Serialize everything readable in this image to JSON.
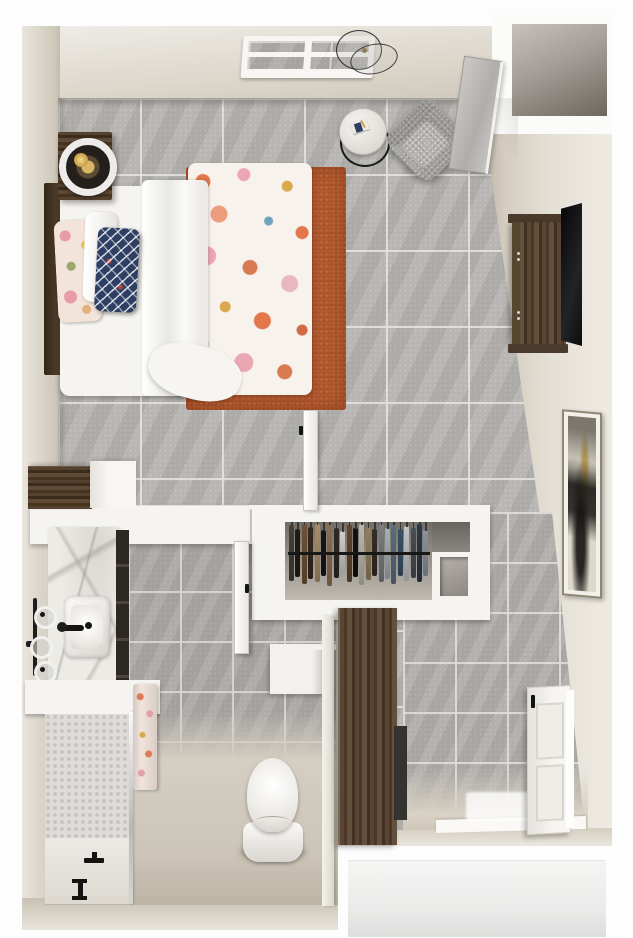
{
  "scene": {
    "type": "3d-floor-plan-render",
    "title": "Studio apartment top-down 3D floor plan rendering",
    "canvas": {
      "width": 633,
      "height": 938
    },
    "visible_text": "none"
  },
  "palette": {
    "background": "#fdfdfd",
    "wall_beige": "#ddd7cb",
    "wall_white": "#f5f4f1",
    "tile_large": "#b3b1ae",
    "tile_small": "#aeaca9",
    "bath_floor": "#d8d2c6",
    "rug_terracotta": "#b45a30",
    "wood_dark": "#4a3728",
    "navy_pillow": "#2e3f63",
    "marble": "#edebe6",
    "black_fixture": "#1b1a18",
    "armchair_gray": "#a6a4a1",
    "tv_black": "#121214",
    "lamp_gold": "#d9b765"
  },
  "rooms": [
    {
      "name": "bedroom-living",
      "label": "Bedroom / Living Area",
      "furniture": [
        "bed",
        "white-blanket",
        "coral-comforter",
        "coral-pillow",
        "white-pillow",
        "navy-pillow",
        "headboard",
        "nightstand",
        "table-lamp",
        "terracotta-rug",
        "round-side-table",
        "book",
        "gray-armchair",
        "leaning-mirror",
        "transom-window",
        "ceiling-light",
        "dresser",
        "wall-tv",
        "framed-art"
      ]
    },
    {
      "name": "closet",
      "label": "Walk-in Closet",
      "furniture": [
        "hanging-clothes",
        "closet-rod",
        "storage-niche",
        "closet-door"
      ]
    },
    {
      "name": "bathroom",
      "label": "Bathroom",
      "furniture": [
        "marble-vanity",
        "vessel-sink",
        "faucet",
        "towel-rack",
        "walk-in-shower",
        "glass-panel",
        "shower-towel",
        "floor-drain",
        "toilet",
        "bathroom-door",
        "sliding-barn-door"
      ]
    },
    {
      "name": "entry-laundry",
      "label": "Entry / Utility",
      "furniture": [
        "white-paneled-door",
        "threshold",
        "floor-mat"
      ]
    },
    {
      "name": "alcove",
      "label": "Entry Alcove"
    }
  ],
  "closet_clothes": {
    "rod_color": "#181816",
    "items": [
      {
        "c": "#46403a",
        "h": 56
      },
      {
        "c": "#211c18",
        "h": 48
      },
      {
        "c": "#6e5238",
        "h": 60
      },
      {
        "c": "#37291d",
        "h": 52
      },
      {
        "c": "#a98f6a",
        "h": 58
      },
      {
        "c": "#191613",
        "h": 46
      },
      {
        "c": "#8a7153",
        "h": 62
      },
      {
        "c": "#2e2a25",
        "h": 50
      },
      {
        "c": "#d2cfc8",
        "h": 44
      },
      {
        "c": "#5f462f",
        "h": 57
      },
      {
        "c": "#14110f",
        "h": 49
      },
      {
        "c": "#bcb9b2",
        "h": 61
      },
      {
        "c": "#93805f",
        "h": 53
      },
      {
        "c": "#332e28",
        "h": 47
      },
      {
        "c": "#7c7e83",
        "h": 58
      },
      {
        "c": "#a2b1bd",
        "h": 51
      },
      {
        "c": "#5c6f7e",
        "h": 60
      },
      {
        "c": "#3d5266",
        "h": 47
      },
      {
        "c": "#c2c5c8",
        "h": 55
      },
      {
        "c": "#4a4d54",
        "h": 50
      },
      {
        "c": "#2a3a4c",
        "h": 58
      },
      {
        "c": "#8c95a0",
        "h": 46
      }
    ]
  }
}
